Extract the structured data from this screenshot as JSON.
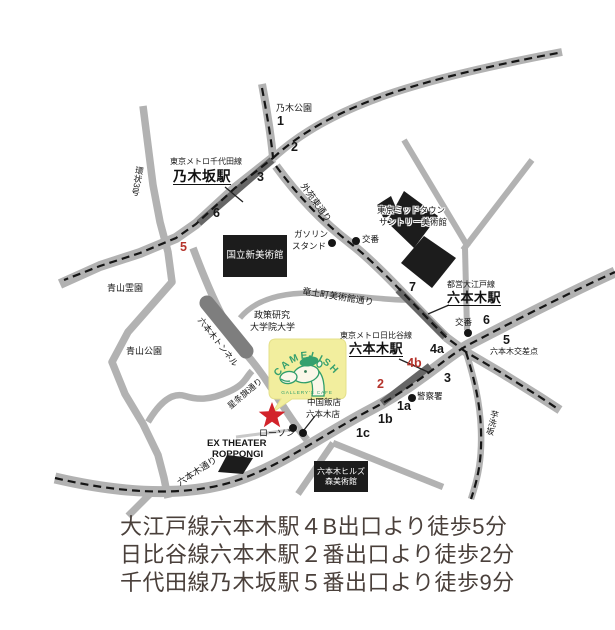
{
  "map": {
    "logo": {
      "name": "CAMELISH",
      "subtitle": "GALLERY'S CAFE"
    },
    "stations": {
      "chiyoda_line": "東京メトロ千代田線",
      "nogizaka": "乃木坂駅",
      "oedo_line": "都営大江戸線",
      "roppongi_oedo": "六本木駅",
      "hibiya_line": "東京メトロ日比谷線",
      "roppongi_hibiya": "六本木駅"
    },
    "places": {
      "nogi_park": "乃木公園",
      "aoyama_cemetery": "青山霊園",
      "aoyama_park": "青山公園",
      "national_art_center": "国立新美術館",
      "gas_station_l1": "ガソリン",
      "gas_station_l2": "スタンド",
      "koban_north": "交番",
      "koban_crossing": "交番",
      "midtown_l1": "東京ミッドタウン",
      "midtown_l2": "サントリー美術館",
      "grips_l1": "政策研究",
      "grips_l2": "大学院大学",
      "roppongi_crossing": "六本木交差点",
      "police": "警察署",
      "chugoku_l1": "中国飯店",
      "chugoku_l2": "六本木店",
      "lawson": "ローソン",
      "ex_theater_l1": "EX THEATER",
      "ex_theater_l2": "ROPPONGI",
      "hills_l1": "六本木ヒルズ",
      "hills_l2": "森美術館"
    },
    "roads": {
      "kanjo3": "環状3号",
      "gaien_higashi": "外苑東通り",
      "ryudocho": "竜土町美術館通り",
      "seijoki": "星条旗通り",
      "roppongi_dori": "六本木通り",
      "imoarai": "芋洗坂",
      "tunnel": "六本木トンネル"
    },
    "exits": {
      "e1": "1",
      "e2": "2",
      "e3": "3",
      "e6": "6",
      "e5": "5",
      "e7": "7",
      "e6b": "6",
      "e5b": "5",
      "e4a": "4a",
      "e3b": "3",
      "e4b": "4b",
      "e2b": "2",
      "e1a": "1a",
      "e1b": "1b",
      "e1c": "1c"
    }
  },
  "directions": {
    "line1": "大江戸線六本木駅４B出口より徒歩5分",
    "line2": "日比谷線六本木駅２番出口より徒歩2分",
    "line3": "千代田線乃木坂駅５番出口より徒歩9分"
  },
  "colors": {
    "road_gray": "#b2b2b2",
    "station_stripe": "#666666",
    "building_black": "#1c1c1c",
    "exit_red": "#b5342c",
    "star_red": "#d2232a",
    "logo_yellow": "#f2ee9e",
    "logo_green": "#35a06e",
    "text_brown": "#4a403b"
  }
}
